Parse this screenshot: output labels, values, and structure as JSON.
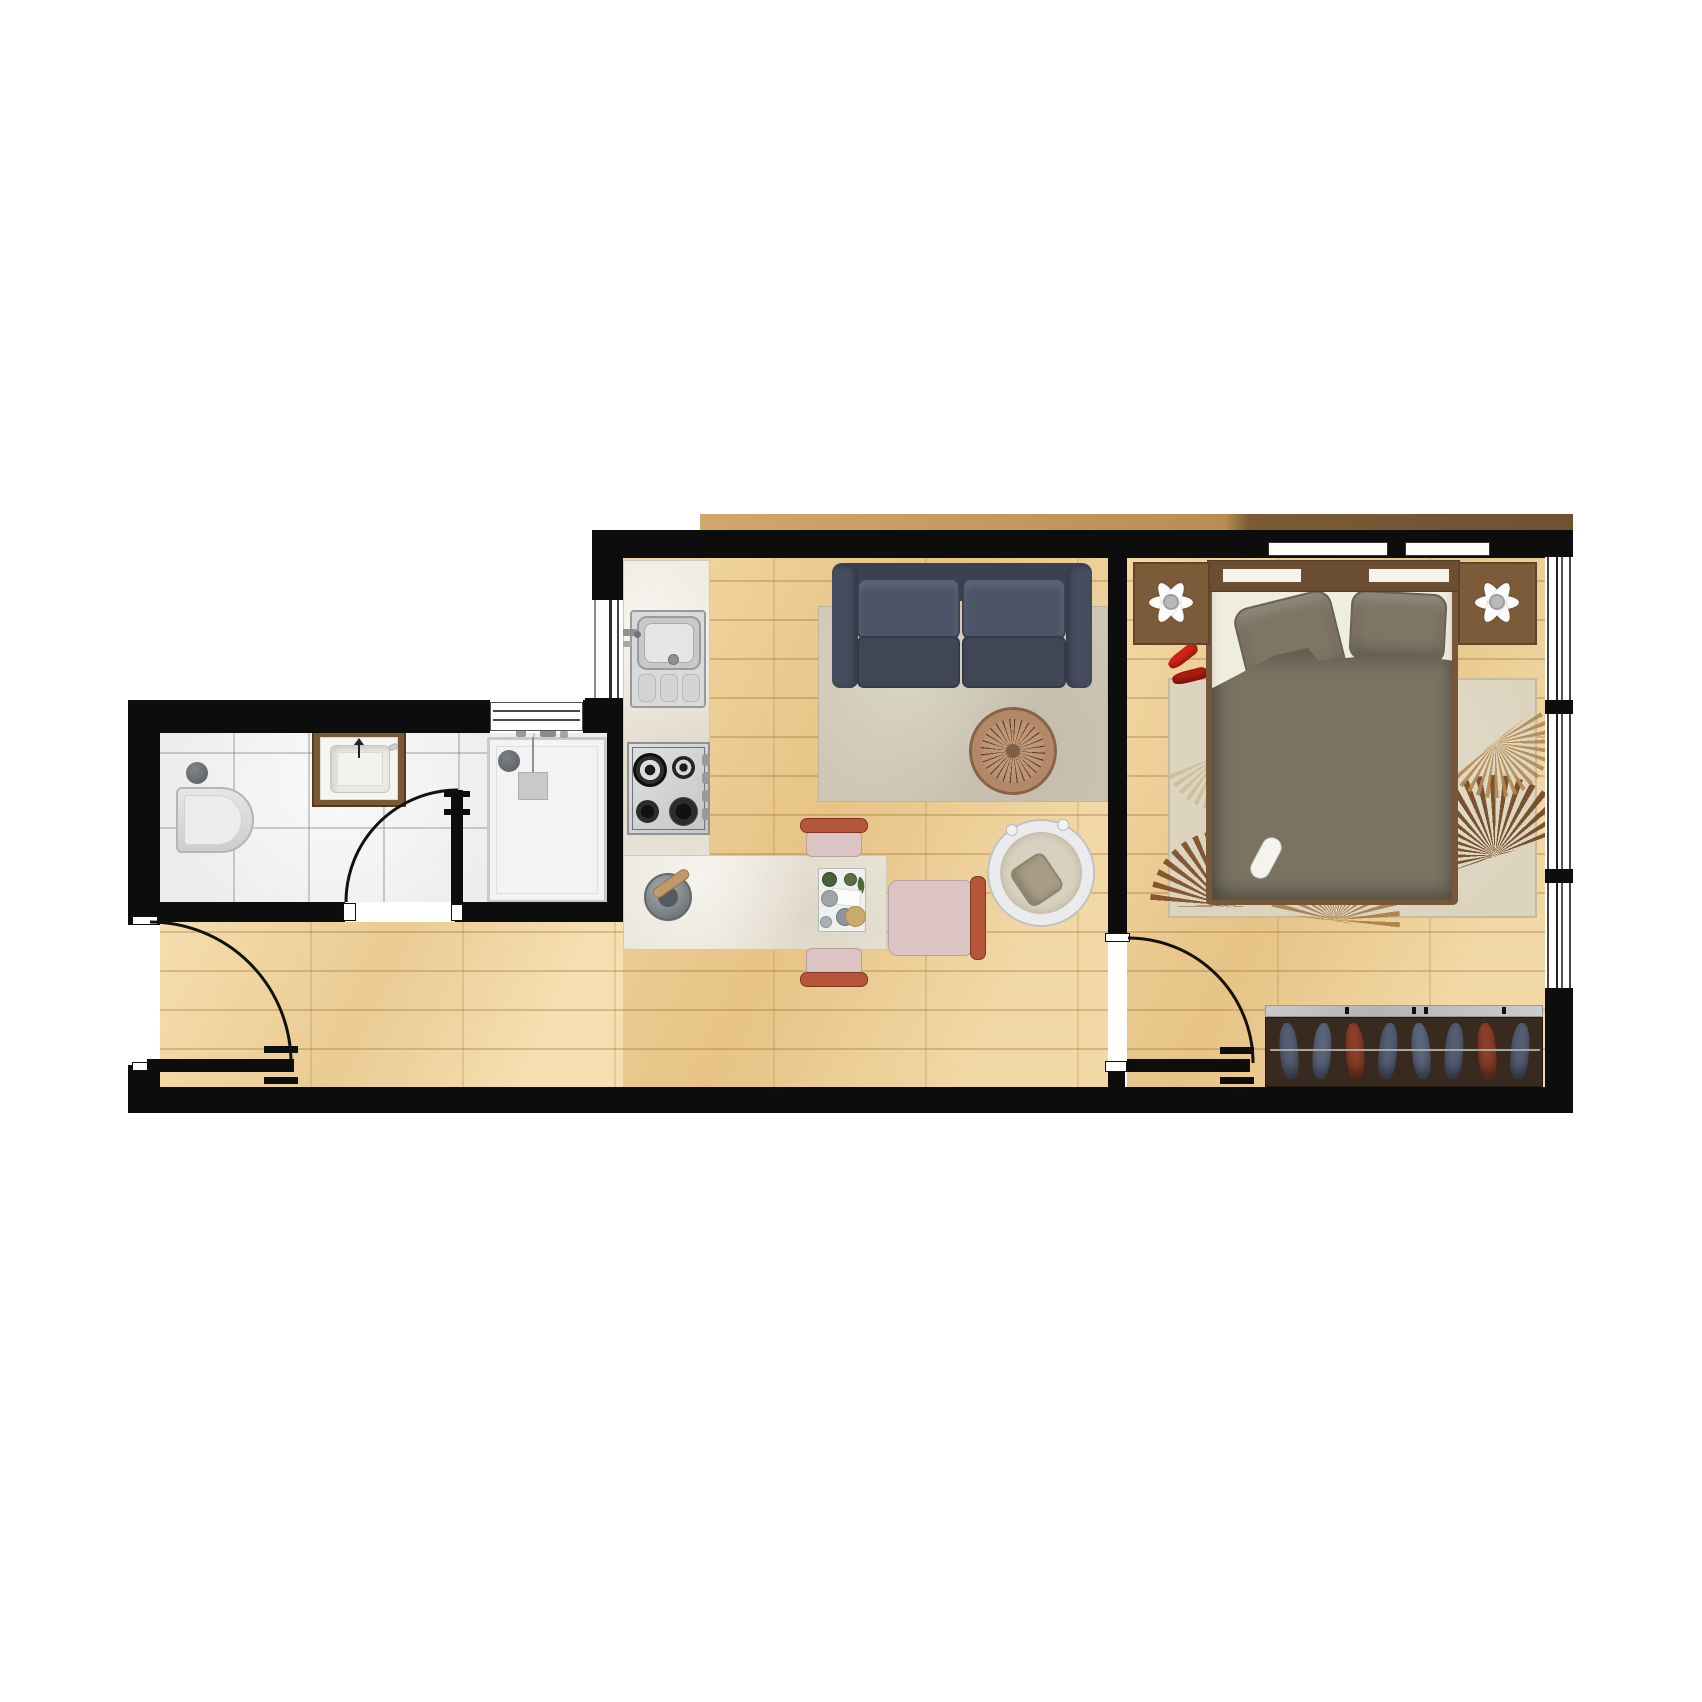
{
  "document": {
    "kind": "apartment-floor-plan",
    "view": "top-down",
    "visible_text": []
  },
  "palette": {
    "wall": "#0d0d0d",
    "wood": "#e9c990",
    "wood_hall": "#eed3a1",
    "tile": "#ededee",
    "marble": "#ebe6da",
    "sofa": "#454c5e",
    "sofa_dark": "#3a4150",
    "rug_living": "#cfc7b5",
    "rug_bedroom": "#ddd4c0",
    "table_wood": "#b3886a",
    "chair_pink": "#dcc3c4",
    "chair_terracotta": "#b5563a",
    "duvet": "#7b7362",
    "headboard": "#6b4e33",
    "nightstand": "#7c5b3b",
    "wardrobe": "#392a1f",
    "clothes_blue": "#58617a",
    "clothes_rust": "#93402a",
    "accent_red": "#cf2317",
    "steel": "#d4d6d8",
    "fixture_white": "#f3f3f3"
  },
  "plan": {
    "rooms": [
      {
        "id": "bathroom",
        "floor": "tile"
      },
      {
        "id": "kitchen-living-room",
        "floor": "wood"
      },
      {
        "id": "bedroom",
        "floor": "wood"
      },
      {
        "id": "hallway",
        "floor": "wood"
      }
    ],
    "doors": [
      {
        "id": "entry-door",
        "swing": "quarter-arc"
      },
      {
        "id": "bathroom-door",
        "swing": "quarter-arc"
      },
      {
        "id": "bedroom-door",
        "swing": "quarter-arc"
      }
    ],
    "windows": [
      {
        "id": "kitchen-window",
        "wall": "west"
      },
      {
        "id": "bathroom-window",
        "wall": "north"
      },
      {
        "id": "bedroom-window",
        "wall": "east"
      },
      {
        "id": "headboard-windows",
        "wall": "north"
      }
    ],
    "fixtures": [
      "toilet",
      "vanity-sink",
      "shower-tray",
      "kitchen-sink",
      "gas-stove",
      "l-shaped-counter",
      "mortar-and-pestle",
      "serving-tray",
      "dining-chairs",
      "sofa",
      "living-rug",
      "round-coffee-table",
      "armchair",
      "double-bed",
      "pillows",
      "duvet",
      "slipper",
      "red-heels",
      "nightstand-left",
      "nightstand-right",
      "table-lamps",
      "bedroom-rug",
      "wardrobe-with-hangers"
    ]
  }
}
